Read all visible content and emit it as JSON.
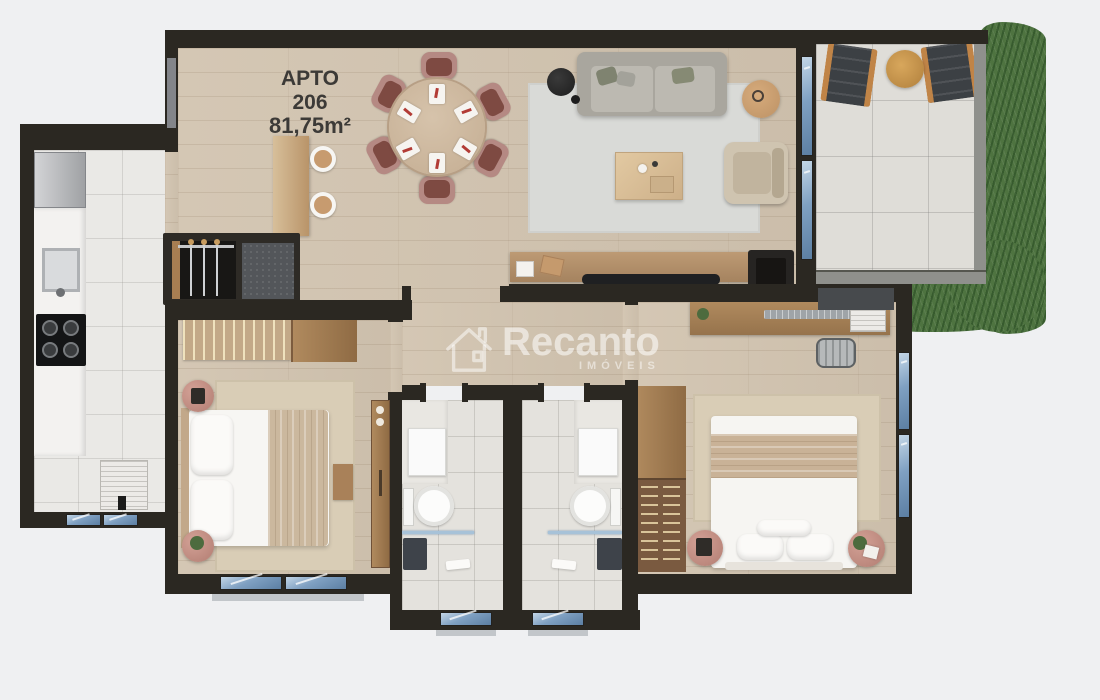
{
  "unit_label": {
    "building": "APTO",
    "number": "206",
    "area": "81,75m²"
  },
  "watermark": {
    "brand": "Recanto",
    "subtitle": "IMÓVEIS"
  },
  "palette": {
    "background": "#eff0f2",
    "wall": "#2b2822",
    "wood_floor": "#d2c4b0",
    "kitchen_tile": "#eae9e6",
    "bath_tile": "#e4e2dd",
    "balcony_tile": "#dfddd8",
    "grass": "#4e7340",
    "window_glass": "#7fa0c2",
    "rug_living": "#d9dad7",
    "rug_bedroom": "#d9cdb6",
    "dining_chair": "#b58983",
    "label_ink": "#3c3a37"
  }
}
